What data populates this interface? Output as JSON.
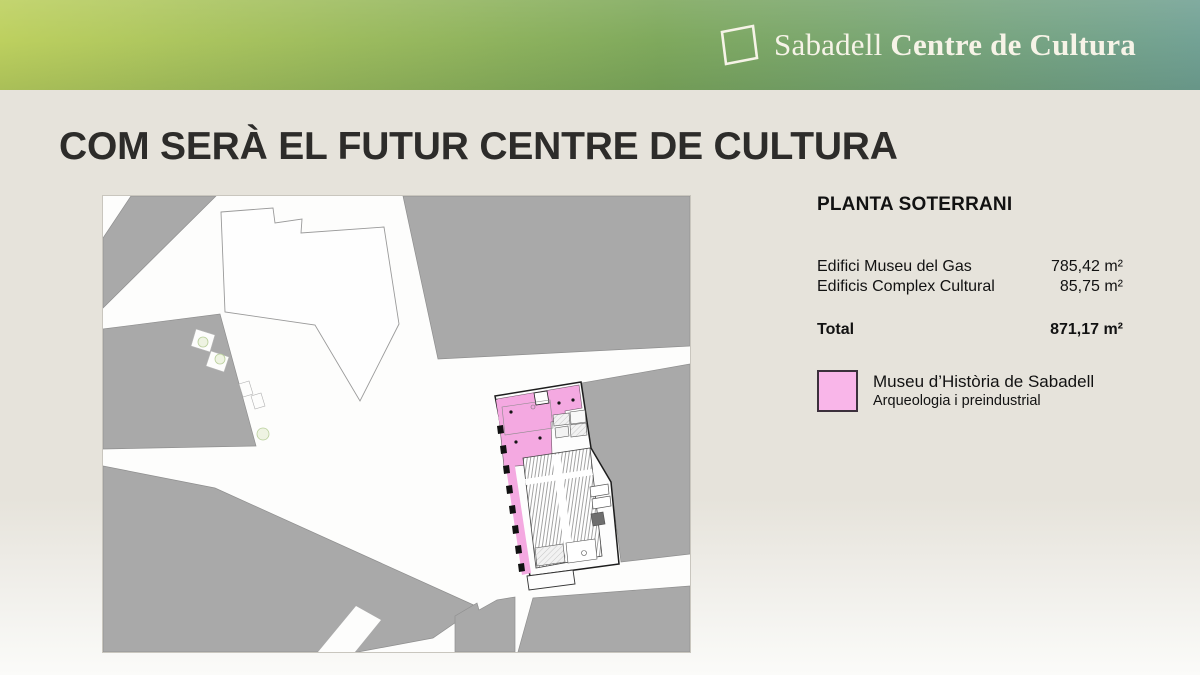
{
  "header": {
    "logo_icon": "square-outline-logo",
    "brand_regular": "Sabadell",
    "brand_bold": "Centre de Cultura"
  },
  "slide": {
    "title": "COM SERÀ EL FUTUR CENTRE DE CULTURA"
  },
  "panel": {
    "heading": "PLANTA SOTERRANI",
    "rows": [
      {
        "label": "Edifici Museu del Gas",
        "value": "785,42 m²"
      },
      {
        "label": "Edificis Complex Cultural",
        "value": "85,75 m²"
      }
    ],
    "total_label": "Total",
    "total_value": "871,17 m²",
    "legend": {
      "swatch": "pink-square-swatch",
      "line1": "Museu d’Història de Sabadell",
      "line2": "Arqueologia i preindustrial"
    }
  },
  "map": {
    "kind": "site-plan-with-highlighted-basement-floor",
    "highlighted_building": "Museu d’Història de Sabadell"
  },
  "colors": {
    "header_gradient_left": "#bdd05f",
    "header_gradient_mid": "#7fa95d",
    "header_gradient_right": "#73a295",
    "slide_bg": "#e6e3db",
    "title_text": "#2d2c2a",
    "map_block_gray": "#a9a9a9",
    "plan_pink": "#f4a9e1",
    "legend_pink": "#f9b6e9",
    "legend_border": "#3c303c"
  }
}
